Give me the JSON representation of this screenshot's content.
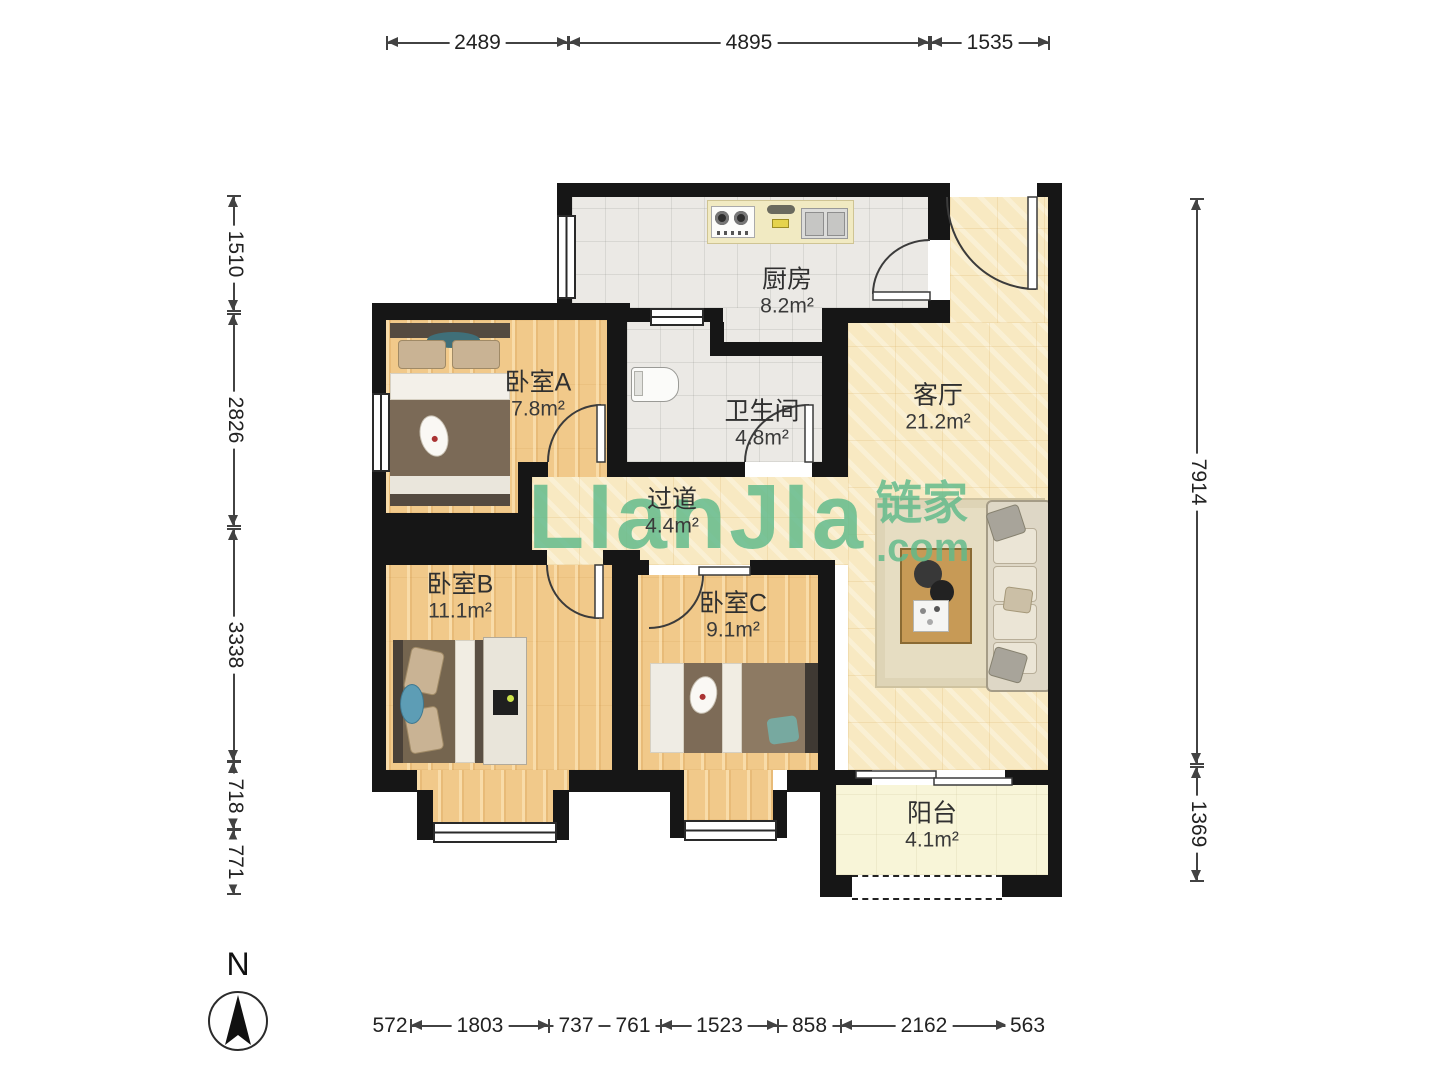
{
  "watermark": {
    "brand": "LIanJIa",
    "brand_cn": "链家",
    "domain": ".com"
  },
  "compass": {
    "label": "N"
  },
  "rooms": [
    {
      "id": "kitchen",
      "name": "厨房",
      "area": "8.2m²"
    },
    {
      "id": "bedroomA",
      "name": "卧室A",
      "area": "7.8m²"
    },
    {
      "id": "bathroom",
      "name": "卫生间",
      "area": "4.8m²"
    },
    {
      "id": "living",
      "name": "客厅",
      "area": "21.2m²"
    },
    {
      "id": "hallway",
      "name": "过道",
      "area": "4.4m²"
    },
    {
      "id": "bedroomB",
      "name": "卧室B",
      "area": "11.1m²"
    },
    {
      "id": "bedroomC",
      "name": "卧室C",
      "area": "9.1m²"
    },
    {
      "id": "balcony",
      "name": "阳台",
      "area": "4.1m²"
    }
  ],
  "dimensions": {
    "top": [
      "2489",
      "4895",
      "1535"
    ],
    "left": [
      "1510",
      "2826",
      "3338",
      "718",
      "771"
    ],
    "right": [
      "7914",
      "1369"
    ],
    "bottom": [
      "572",
      "1803",
      "737",
      "761",
      "1523",
      "858",
      "2162",
      "563"
    ]
  }
}
